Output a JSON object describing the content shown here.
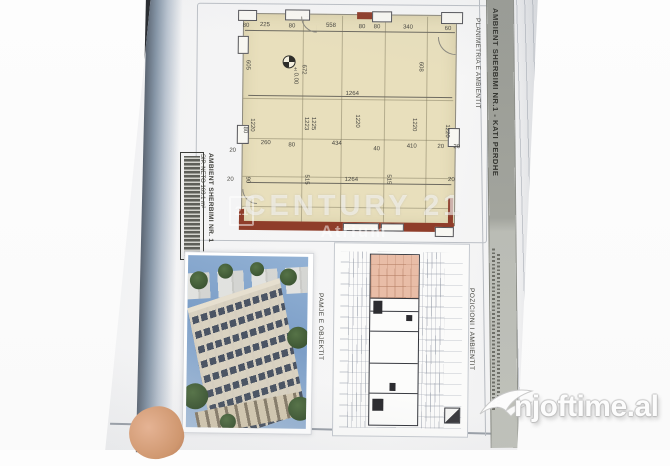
{
  "titleband": {
    "main": "AMBIENT SHERBIMI NR.1 - KATI PERDHE",
    "sub": "PLANIMETRIA E AMBIENTIT"
  },
  "stamp": {
    "line1": "AMBIENT SHERBIMI NR. 1",
    "line2": "SIP. NETO  163.1 m²"
  },
  "captions": {
    "building_photo": "PAMJE E OBJEKTIT",
    "key_plan": "POZICIONI I AMBIENTIT"
  },
  "watermarks": {
    "brand": "CENTURY 21",
    "office": "Atrium",
    "seal": "21",
    "site": "njoftime.al"
  },
  "plan": {
    "level_marker": "±0.00",
    "labels": [
      {
        "v": "80",
        "x": 245,
        "y": 27
      },
      {
        "v": "225",
        "x": 264,
        "y": 26
      },
      {
        "v": "80",
        "x": 291,
        "y": 27
      },
      {
        "v": "558",
        "x": 330,
        "y": 26
      },
      {
        "v": "80",
        "x": 361,
        "y": 27
      },
      {
        "v": "80",
        "x": 376,
        "y": 27
      },
      {
        "v": "340",
        "x": 407,
        "y": 27
      },
      {
        "v": "60",
        "x": 447,
        "y": 28
      },
      {
        "v": "605",
        "x": 247,
        "y": 66,
        "r": 1
      },
      {
        "v": "672",
        "x": 303,
        "y": 70,
        "r": 1
      },
      {
        "v": "608",
        "x": 420,
        "y": 66,
        "r": 1
      },
      {
        "v": "±0.00",
        "x": 295,
        "y": 76,
        "r": 1
      },
      {
        "v": "1264",
        "x": 352,
        "y": 94
      },
      {
        "v": "1220",
        "x": 252,
        "y": 126,
        "r": 1
      },
      {
        "v": "1223",
        "x": 306,
        "y": 124,
        "r": 1
      },
      {
        "v": "1225",
        "x": 313,
        "y": 124,
        "r": 1
      },
      {
        "v": "1220",
        "x": 357,
        "y": 121,
        "r": 1
      },
      {
        "v": "1220",
        "x": 414,
        "y": 124,
        "r": 1
      },
      {
        "v": "1220",
        "x": 447,
        "y": 130,
        "r": 1
      },
      {
        "v": "80",
        "x": 245,
        "y": 131,
        "r": 1
      },
      {
        "v": "20",
        "x": 233,
        "y": 152
      },
      {
        "v": "260",
        "x": 266,
        "y": 144
      },
      {
        "v": "80",
        "x": 292,
        "y": 146
      },
      {
        "v": "434",
        "x": 337,
        "y": 144
      },
      {
        "v": "40",
        "x": 377,
        "y": 149
      },
      {
        "v": "410",
        "x": 412,
        "y": 146
      },
      {
        "v": "20",
        "x": 441,
        "y": 146
      },
      {
        "v": "20",
        "x": 457,
        "y": 146
      },
      {
        "v": "90",
        "x": 248,
        "y": 181,
        "r": 1
      },
      {
        "v": "20",
        "x": 231,
        "y": 181
      },
      {
        "v": "515",
        "x": 307,
        "y": 180,
        "r": 1
      },
      {
        "v": "1264",
        "x": 352,
        "y": 180
      },
      {
        "v": "515",
        "x": 389,
        "y": 179,
        "r": 1
      },
      {
        "v": "20",
        "x": 452,
        "y": 179
      }
    ]
  },
  "colors": {
    "plan_fill": "#e8dfbc",
    "wall_red": "#8f3d2a",
    "highlight_pink": "#e9bda7",
    "band_grey": "#9b9d96",
    "paper_edge_blue": "#8595a6"
  }
}
